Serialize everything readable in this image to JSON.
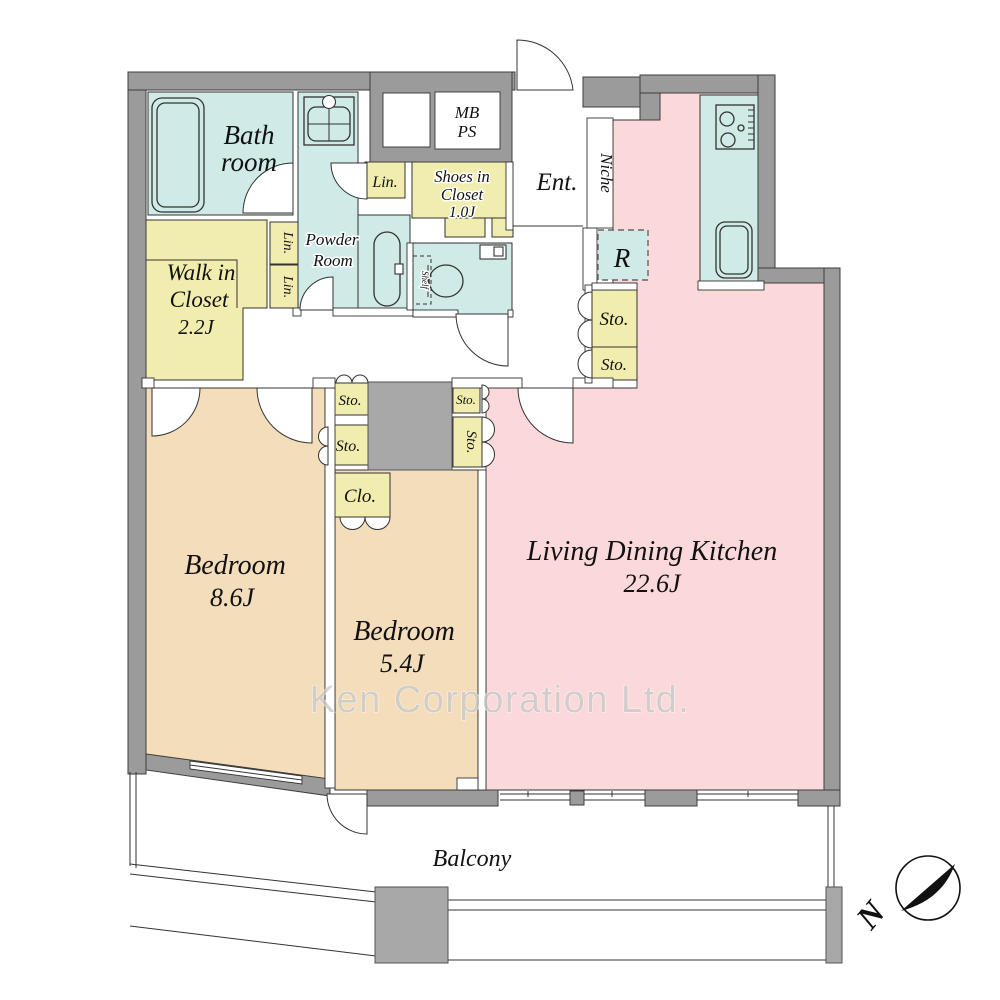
{
  "rooms": {
    "bathroom": {
      "line1": "Bath",
      "line2": "room"
    },
    "powder_room": {
      "line1": "Powder",
      "line2": "Room"
    },
    "walk_in_closet": {
      "line1": "Walk in",
      "line2": "Closet",
      "size": "2.2J"
    },
    "shoes_closet": {
      "line1": "Shoes in",
      "line2": "Closet",
      "size": "1.0J"
    },
    "entrance": "Ent.",
    "niche": "Niche",
    "meter_box": {
      "line1": "MB",
      "line2": "PS"
    },
    "refrigerator": "R",
    "storage": "Sto.",
    "closet_small": "Clo.",
    "linen": "Lin.",
    "shelf": "Shelf",
    "bedroom_label": "Bedroom",
    "bedroom1_size": "8.6J",
    "bedroom2_size": "5.4J",
    "ldk": {
      "name": "Living Dining Kitchen",
      "size": "22.6J"
    },
    "balcony": "Balcony"
  },
  "watermark": "Ken Corporation Ltd.",
  "compass": {
    "north": "N"
  },
  "colors": {
    "wall_gray": "#9b9b9b",
    "pillar_gray": "#a8a8a8",
    "wet_area_cyan": "#cfeae7",
    "closet_yellow": "#f1edae",
    "bedroom_tan": "#f3ddbb",
    "ldk_pink": "#fbd9da"
  }
}
